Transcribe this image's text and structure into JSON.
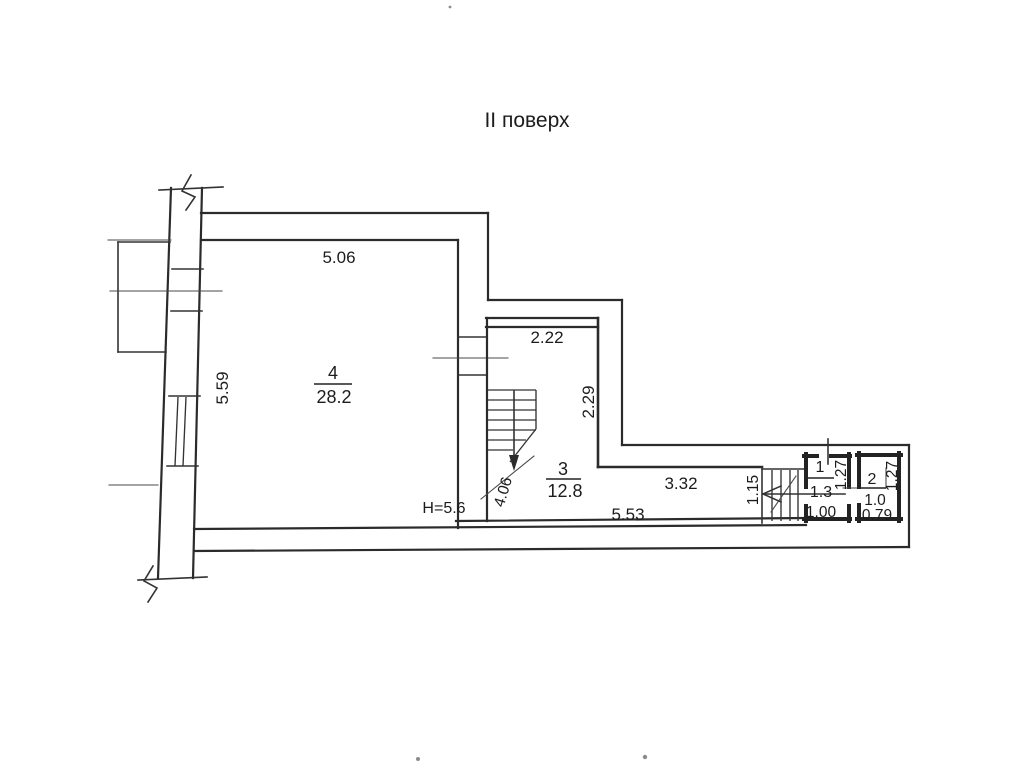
{
  "title": "II поверх",
  "plan": {
    "rooms": [
      {
        "number": "4",
        "area": "28.2"
      },
      {
        "number": "3",
        "area": "12.8"
      },
      {
        "number": "1",
        "area": "1.3"
      },
      {
        "number": "2",
        "area": "1.0"
      }
    ],
    "height_note": "Н=5.6",
    "dimensions": {
      "room4_width_top": "5.06",
      "room4_depth_left": "5.59",
      "room3_width_top": "2.22",
      "room3_depth_right": "2.29",
      "stair_run": "4.06",
      "corridor_width": "3.32",
      "corridor_length_bottom": "5.53",
      "small_stair_width": "1.15",
      "room1_width": "1.00",
      "room1_depth": "1.27",
      "room2_width": "0.79",
      "room2_depth": "1.27"
    }
  },
  "colors": {
    "ink": "#2b2b2b",
    "paper": "#ffffff"
  }
}
